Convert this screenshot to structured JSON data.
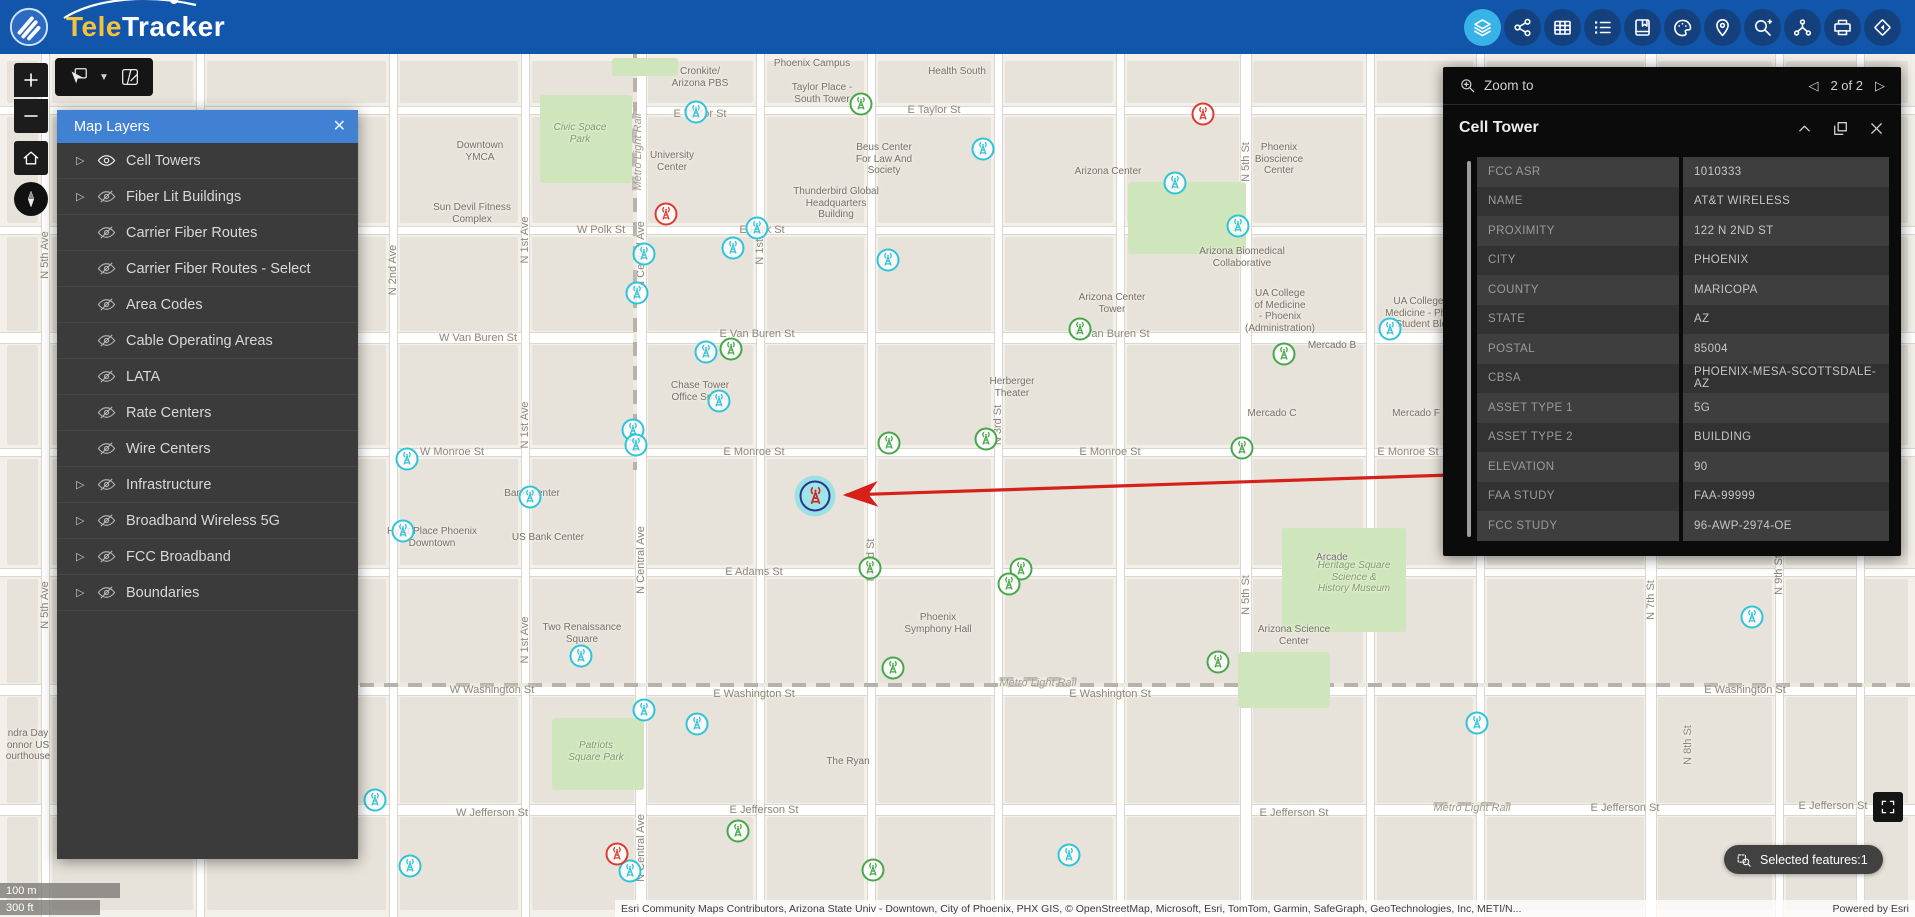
{
  "header": {
    "logo": {
      "tele": "Tele",
      "tracker": "Tracker"
    },
    "toolbar": [
      {
        "name": "layers",
        "active": true
      },
      {
        "name": "share",
        "active": false
      },
      {
        "name": "table",
        "active": false
      },
      {
        "name": "legend-list",
        "active": false
      },
      {
        "name": "bookmark",
        "active": false
      },
      {
        "name": "draw",
        "active": false
      },
      {
        "name": "locate-pin",
        "active": false
      },
      {
        "name": "query-search",
        "active": false
      },
      {
        "name": "network-route",
        "active": false
      },
      {
        "name": "print",
        "active": false
      },
      {
        "name": "basemap-diamond",
        "active": false
      }
    ],
    "colors": {
      "bar": "#1256ac",
      "button": "#14417e",
      "active_button": "#38b3e8"
    }
  },
  "layers_panel": {
    "title": "Map Layers",
    "items": [
      {
        "label": "Cell Towers",
        "expandable": true,
        "visible": true
      },
      {
        "label": "Fiber Lit Buildings",
        "expandable": true,
        "visible": false
      },
      {
        "label": "Carrier Fiber Routes",
        "expandable": false,
        "visible": false
      },
      {
        "label": "Carrier Fiber Routes - Select",
        "expandable": false,
        "visible": false
      },
      {
        "label": "Area Codes",
        "expandable": false,
        "visible": false
      },
      {
        "label": "Cable Operating Areas",
        "expandable": false,
        "visible": false
      },
      {
        "label": "LATA",
        "expandable": false,
        "visible": false
      },
      {
        "label": "Rate Centers",
        "expandable": false,
        "visible": false
      },
      {
        "label": "Wire Centers",
        "expandable": false,
        "visible": false
      },
      {
        "label": "Infrastructure",
        "expandable": true,
        "visible": false
      },
      {
        "label": "Broadband Wireless 5G",
        "expandable": true,
        "visible": false
      },
      {
        "label": "FCC Broadband",
        "expandable": true,
        "visible": false
      },
      {
        "label": "Boundaries",
        "expandable": true,
        "visible": false
      }
    ]
  },
  "feature_panel": {
    "zoom_to_label": "Zoom to",
    "pagination": "2 of 2",
    "title": "Cell Tower",
    "fields": [
      {
        "label": "FCC ASR",
        "value": "1010333"
      },
      {
        "label": "NAME",
        "value": "AT&T WIRELESS"
      },
      {
        "label": "PROXIMITY",
        "value": "122 N 2ND ST"
      },
      {
        "label": "CITY",
        "value": "PHOENIX"
      },
      {
        "label": "COUNTY",
        "value": "MARICOPA"
      },
      {
        "label": "STATE",
        "value": "AZ"
      },
      {
        "label": "POSTAL",
        "value": "85004"
      },
      {
        "label": "CBSA",
        "value": "PHOENIX-MESA-SCOTTSDALE-AZ"
      },
      {
        "label": "ASSET TYPE 1",
        "value": "5G"
      },
      {
        "label": "ASSET TYPE 2",
        "value": "BUILDING"
      },
      {
        "label": "ELEVATION",
        "value": "90"
      },
      {
        "label": "FAA STUDY",
        "value": "FAA-99999"
      },
      {
        "label": "FCC STUDY",
        "value": "96-AWP-2974-OE"
      }
    ]
  },
  "status": {
    "selected_features": "Selected features:1"
  },
  "scale_bar": {
    "metric": "100 m",
    "imperial": "300 ft"
  },
  "attribution": {
    "text": "Esri Community Maps Contributors, Arizona State Univ - Downtown, City of Phoenix, PHX GIS, © OpenStreetMap, Microsoft, Esri, TomTom, Garmin, SafeGraph, GeoTechnologies, Inc, METI/N...",
    "powered_by": "Powered by Esri"
  },
  "map": {
    "marker_colors": {
      "cyan": "#2ec4d9",
      "green": "#46a84b",
      "red": "#de3b30",
      "selected_ring": "#223a8f",
      "selected_tower": "#d6201a"
    },
    "grid_v": [
      0,
      45,
      200,
      393,
      525,
      641,
      760,
      871,
      998,
      1120,
      1246,
      1370,
      1480,
      1651,
      1779,
      1915
    ],
    "grid_h": [
      54,
      110,
      230,
      338,
      452,
      572,
      690,
      810,
      917
    ],
    "streets_h": [
      {
        "y": 110,
        "major": false
      },
      {
        "y": 230,
        "major": false
      },
      {
        "y": 338,
        "major": true
      },
      {
        "y": 452,
        "major": false
      },
      {
        "y": 572,
        "major": false
      },
      {
        "y": 690,
        "major": true
      },
      {
        "y": 810,
        "major": true
      }
    ],
    "streets_v": [
      {
        "x": 45,
        "major": false
      },
      {
        "x": 200,
        "major": false
      },
      {
        "x": 393,
        "major": false
      },
      {
        "x": 525,
        "major": false
      },
      {
        "x": 641,
        "major": true
      },
      {
        "x": 760,
        "major": false
      },
      {
        "x": 871,
        "major": false
      },
      {
        "x": 998,
        "major": false
      },
      {
        "x": 1120,
        "major": false
      },
      {
        "x": 1246,
        "major": true
      },
      {
        "x": 1370,
        "major": false
      },
      {
        "x": 1480,
        "major": false
      },
      {
        "x": 1651,
        "major": true
      },
      {
        "x": 1779,
        "major": false
      },
      {
        "x": 1860,
        "major": false
      }
    ],
    "rail_h": {
      "y": 683,
      "x1": 360,
      "x2": 1915
    },
    "rail_v": {
      "x": 633,
      "y1": 54,
      "y2": 470
    },
    "parks": [
      {
        "x": 540,
        "y": 95,
        "w": 92,
        "h": 88
      },
      {
        "x": 1128,
        "y": 182,
        "w": 118,
        "h": 72
      },
      {
        "x": 1282,
        "y": 528,
        "w": 124,
        "h": 104
      },
      {
        "x": 1238,
        "y": 652,
        "w": 92,
        "h": 56
      },
      {
        "x": 552,
        "y": 718,
        "w": 92,
        "h": 72
      },
      {
        "x": 612,
        "y": 58,
        "w": 66,
        "h": 18
      }
    ],
    "street_labels_h": [
      {
        "t": "E Taylor St",
        "x": 934,
        "y": 110
      },
      {
        "t": "E Taylor St",
        "x": 700,
        "y": 114
      },
      {
        "t": "W Polk St",
        "x": 601,
        "y": 230
      },
      {
        "t": "E Polk St",
        "x": 762,
        "y": 230
      },
      {
        "t": "W Van Buren St",
        "x": 478,
        "y": 338
      },
      {
        "t": "E Van Buren St",
        "x": 757,
        "y": 334
      },
      {
        "t": "E Van Buren St",
        "x": 1112,
        "y": 334
      },
      {
        "t": "W Monroe St",
        "x": 452,
        "y": 452
      },
      {
        "t": "E Monroe St",
        "x": 754,
        "y": 452
      },
      {
        "t": "E Monroe St",
        "x": 1110,
        "y": 452
      },
      {
        "t": "E Monroe St",
        "x": 1408,
        "y": 452
      },
      {
        "t": "E Adams St",
        "x": 754,
        "y": 572
      },
      {
        "t": "W Washington St",
        "x": 492,
        "y": 690
      },
      {
        "t": "E Washington St",
        "x": 754,
        "y": 694
      },
      {
        "t": "E Washington St",
        "x": 1110,
        "y": 694
      },
      {
        "t": "E Washington St",
        "x": 1745,
        "y": 690
      },
      {
        "t": "W Jefferson St",
        "x": 492,
        "y": 813
      },
      {
        "t": "E Jefferson St",
        "x": 764,
        "y": 810
      },
      {
        "t": "E Jefferson St",
        "x": 1294,
        "y": 813
      },
      {
        "t": "E Jefferson St",
        "x": 1625,
        "y": 808
      },
      {
        "t": "E Jefferson St",
        "x": 1833,
        "y": 806
      }
    ],
    "street_labels_v": [
      {
        "t": "N 5th Ave",
        "x": 45,
        "y": 255
      },
      {
        "t": "N 5th Ave",
        "x": 45,
        "y": 605
      },
      {
        "t": "N 2nd Ave",
        "x": 393,
        "y": 270
      },
      {
        "t": "N 1st Ave",
        "x": 525,
        "y": 240
      },
      {
        "t": "N 1st Ave",
        "x": 525,
        "y": 425
      },
      {
        "t": "N 1st Ave",
        "x": 525,
        "y": 640
      },
      {
        "t": "N Central Ave",
        "x": 641,
        "y": 255
      },
      {
        "t": "N Central Ave",
        "x": 641,
        "y": 560
      },
      {
        "t": "N Central Ave",
        "x": 641,
        "y": 848
      },
      {
        "t": "N 1st St",
        "x": 760,
        "y": 245
      },
      {
        "t": "N 2nd St",
        "x": 871,
        "y": 560
      },
      {
        "t": "N 3rd St",
        "x": 998,
        "y": 425
      },
      {
        "t": "N 5th St",
        "x": 1246,
        "y": 162
      },
      {
        "t": "N 5th St",
        "x": 1246,
        "y": 595
      },
      {
        "t": "N 7th St",
        "x": 1651,
        "y": 600
      },
      {
        "t": "N 8th St",
        "x": 1688,
        "y": 745
      },
      {
        "t": "N 9th St",
        "x": 1779,
        "y": 575
      },
      {
        "t": "Metro Light Rail",
        "x": 634,
        "y": 152,
        "rail": true
      }
    ],
    "rail_labels": [
      {
        "t": "Metro Light Rail",
        "x": 1038,
        "y": 679
      },
      {
        "t": "Metro Light Rail",
        "x": 1472,
        "y": 804
      }
    ],
    "pois": [
      {
        "t": "Phoenix Campus",
        "x": 812,
        "y": 58
      },
      {
        "t": "Cronkite/\nArizona PBS",
        "x": 700,
        "y": 66
      },
      {
        "t": "Taylor Place -\nSouth Tower",
        "x": 822,
        "y": 82
      },
      {
        "t": "Health South",
        "x": 957,
        "y": 66
      },
      {
        "t": "Beus Center\nFor Law And\nSociety",
        "x": 884,
        "y": 142
      },
      {
        "t": "Arizona Center",
        "x": 1108,
        "y": 166
      },
      {
        "t": "Phoenix\nBioscience\nCenter",
        "x": 1279,
        "y": 142
      },
      {
        "t": "Downtown\nYMCA",
        "x": 480,
        "y": 140
      },
      {
        "t": "Civic Space\nPark",
        "x": 580,
        "y": 122,
        "park": true
      },
      {
        "t": "University\nCenter",
        "x": 672,
        "y": 150
      },
      {
        "t": "Thunderbird Global\nHeadquarters\nBuilding",
        "x": 836,
        "y": 186
      },
      {
        "t": "Sun Devil Fitness\nComplex",
        "x": 472,
        "y": 202
      },
      {
        "t": "Arizona Biomedical\nCollaborative",
        "x": 1242,
        "y": 246
      },
      {
        "t": "Arizona Center\nTower",
        "x": 1112,
        "y": 292
      },
      {
        "t": "UA College\nof Medicine\n- Phoenix\n(Administration)",
        "x": 1280,
        "y": 288
      },
      {
        "t": "UA College of\nMedicine - Phoen\n(Student Bldg)",
        "x": 1424,
        "y": 296
      },
      {
        "t": "Chase Tower\nOffice Space",
        "x": 700,
        "y": 380
      },
      {
        "t": "Herberger\nTheater",
        "x": 1012,
        "y": 376
      },
      {
        "t": "Mercado B",
        "x": 1332,
        "y": 340
      },
      {
        "t": "Mercado C",
        "x": 1272,
        "y": 408
      },
      {
        "t": "Mercado F",
        "x": 1416,
        "y": 408
      },
      {
        "t": "Hyatt Place Phoenix\nDowntown",
        "x": 432,
        "y": 526
      },
      {
        "t": "Bank Center",
        "x": 532,
        "y": 488
      },
      {
        "t": "US Bank Center",
        "x": 548,
        "y": 532
      },
      {
        "t": "Phoenix\nSymphony Hall",
        "x": 938,
        "y": 612
      },
      {
        "t": "Arcade",
        "x": 1332,
        "y": 552
      },
      {
        "t": "Heritage Square\nScience &\nHistory Museum",
        "x": 1354,
        "y": 560,
        "park": true
      },
      {
        "t": "Two Renaissance\nSquare",
        "x": 582,
        "y": 622
      },
      {
        "t": "Arizona Science\nCenter",
        "x": 1294,
        "y": 624
      },
      {
        "t": "The Ryan",
        "x": 848,
        "y": 756
      },
      {
        "t": "Patriots\nSquare Park",
        "x": 596,
        "y": 740,
        "park": true
      },
      {
        "t": "ndra Day\nonnor US\nourthouse",
        "x": 28,
        "y": 728
      }
    ],
    "markers": [
      {
        "x": 696,
        "y": 112,
        "c": "cyan"
      },
      {
        "x": 983,
        "y": 149,
        "c": "cyan"
      },
      {
        "x": 1175,
        "y": 183,
        "c": "cyan"
      },
      {
        "x": 1238,
        "y": 226,
        "c": "cyan"
      },
      {
        "x": 757,
        "y": 228,
        "c": "cyan"
      },
      {
        "x": 733,
        "y": 248,
        "c": "cyan"
      },
      {
        "x": 644,
        "y": 254,
        "c": "cyan"
      },
      {
        "x": 888,
        "y": 260,
        "c": "cyan"
      },
      {
        "x": 637,
        "y": 293,
        "c": "cyan"
      },
      {
        "x": 706,
        "y": 352,
        "c": "cyan"
      },
      {
        "x": 719,
        "y": 401,
        "c": "cyan"
      },
      {
        "x": 633,
        "y": 430,
        "c": "cyan"
      },
      {
        "x": 636,
        "y": 445,
        "c": "cyan"
      },
      {
        "x": 407,
        "y": 459,
        "c": "cyan"
      },
      {
        "x": 530,
        "y": 497,
        "c": "cyan"
      },
      {
        "x": 403,
        "y": 531,
        "c": "cyan"
      },
      {
        "x": 581,
        "y": 656,
        "c": "cyan"
      },
      {
        "x": 644,
        "y": 710,
        "c": "cyan"
      },
      {
        "x": 697,
        "y": 724,
        "c": "cyan"
      },
      {
        "x": 375,
        "y": 800,
        "c": "cyan"
      },
      {
        "x": 410,
        "y": 866,
        "c": "cyan"
      },
      {
        "x": 630,
        "y": 871,
        "c": "cyan"
      },
      {
        "x": 1069,
        "y": 855,
        "c": "cyan"
      },
      {
        "x": 1390,
        "y": 329,
        "c": "cyan"
      },
      {
        "x": 1752,
        "y": 617,
        "c": "cyan"
      },
      {
        "x": 1477,
        "y": 723,
        "c": "cyan"
      },
      {
        "x": 861,
        "y": 104,
        "c": "green"
      },
      {
        "x": 1080,
        "y": 329,
        "c": "green"
      },
      {
        "x": 731,
        "y": 349,
        "c": "green"
      },
      {
        "x": 986,
        "y": 439,
        "c": "green"
      },
      {
        "x": 889,
        "y": 443,
        "c": "green"
      },
      {
        "x": 1242,
        "y": 448,
        "c": "green"
      },
      {
        "x": 870,
        "y": 568,
        "c": "green"
      },
      {
        "x": 1021,
        "y": 569,
        "c": "green"
      },
      {
        "x": 1009,
        "y": 584,
        "c": "green"
      },
      {
        "x": 893,
        "y": 668,
        "c": "green"
      },
      {
        "x": 1218,
        "y": 662,
        "c": "green"
      },
      {
        "x": 738,
        "y": 831,
        "c": "green"
      },
      {
        "x": 873,
        "y": 870,
        "c": "green"
      },
      {
        "x": 1284,
        "y": 354,
        "c": "green"
      },
      {
        "x": 1203,
        "y": 114,
        "c": "red"
      },
      {
        "x": 666,
        "y": 214,
        "c": "red"
      },
      {
        "x": 617,
        "y": 854,
        "c": "red"
      }
    ],
    "selected_marker": {
      "x": 815,
      "y": 496
    },
    "arrow": {
      "x1": 1451,
      "y1": 475,
      "x2": 846,
      "y2": 495,
      "color": "#d6201a"
    }
  }
}
